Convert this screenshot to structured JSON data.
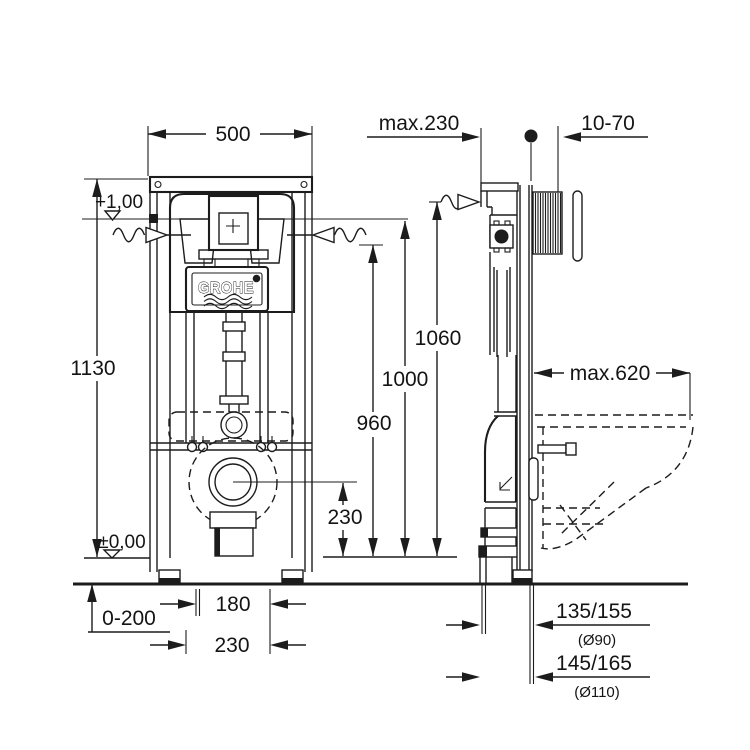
{
  "drawing": {
    "brand": "GROHE",
    "front": {
      "width": "500",
      "height": "1130",
      "level_top": "+1,00",
      "level_floor": "±0,00",
      "foot_range": "0-200",
      "offset_narrow": "180",
      "offset_wide": "230",
      "drain_height": "230"
    },
    "heights": {
      "h960": "960",
      "h1000": "1000",
      "h1060": "1060"
    },
    "side": {
      "top_depth": "max.230",
      "wall_thickness": "10-70",
      "bowl_depth": "max.620",
      "drain_90": "135/155",
      "drain_90_dia": "(Ø90)",
      "drain_110": "145/165",
      "drain_110_dia": "(Ø110)"
    }
  }
}
